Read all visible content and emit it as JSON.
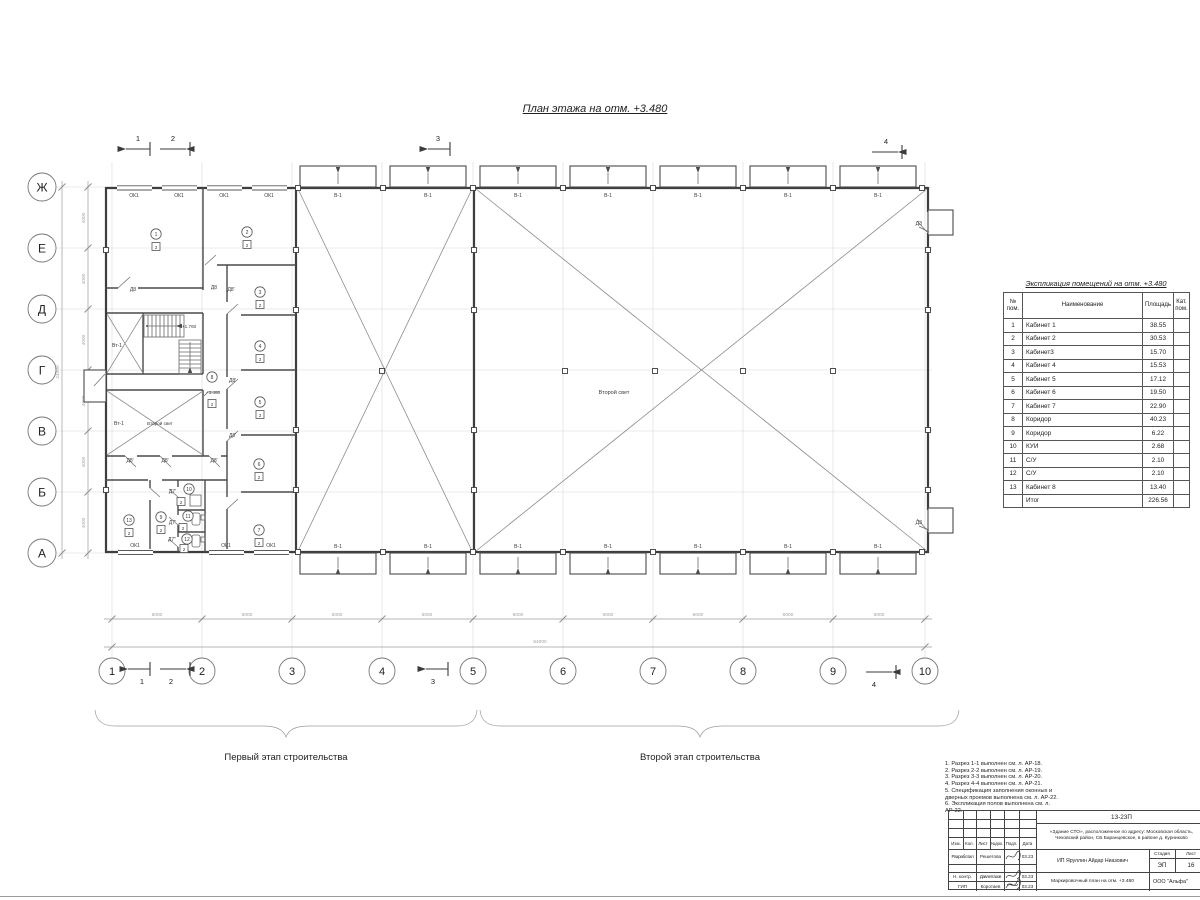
{
  "page": {
    "title": "План этажа на отм. +3.480"
  },
  "axes": {
    "h": [
      "1",
      "2",
      "3",
      "4",
      "5",
      "6",
      "7",
      "8",
      "9",
      "10"
    ],
    "v": [
      "Ж",
      "Е",
      "Д",
      "Г",
      "В",
      "Б",
      "А"
    ],
    "bay_h": "6000",
    "total_h": "54000",
    "bay_v": "4000",
    "total_v": "24000"
  },
  "sections": [
    "1",
    "2",
    "3",
    "4"
  ],
  "labels": {
    "window": "ОК1",
    "gate": "В-1",
    "door_d3": "ДЗ",
    "door_d8": "Д8",
    "door_d8p": "Д8'",
    "door_d7p": "Д7'",
    "door_d7pp": "Д7\"",
    "vt": "Вт-1",
    "second_light": "Второй свет",
    "level_main": "+3.480",
    "level_stair": "+1.760"
  },
  "rooms": [
    {
      "n": "1",
      "cat": "2"
    },
    {
      "n": "2",
      "cat": "2"
    },
    {
      "n": "3",
      "cat": "2"
    },
    {
      "n": "4",
      "cat": "2"
    },
    {
      "n": "5",
      "cat": "2"
    },
    {
      "n": "6",
      "cat": "2"
    },
    {
      "n": "7",
      "cat": "2"
    },
    {
      "n": "8",
      "cat": "2"
    },
    {
      "n": "9",
      "cat": "2"
    },
    {
      "n": "10",
      "cat": "2"
    },
    {
      "n": "11",
      "cat": "2"
    },
    {
      "n": "12",
      "cat": "2"
    },
    {
      "n": "13",
      "cat": "2"
    }
  ],
  "stages": {
    "first": "Первый этап строительства",
    "second": "Второй этап строительства"
  },
  "explication": {
    "title": "Экспликация помещений на отм. +3.480",
    "col_num": "№ пом.",
    "col_name": "Наименование",
    "col_area": "Площадь",
    "col_cat": "Кат. пом.",
    "rows": [
      {
        "n": "1",
        "name": "Кабинет 1",
        "area": "38.55"
      },
      {
        "n": "2",
        "name": "Кабинет 2",
        "area": "30.53"
      },
      {
        "n": "3",
        "name": "Кабинет3",
        "area": "15.70"
      },
      {
        "n": "4",
        "name": "Кабинет 4",
        "area": "15.53"
      },
      {
        "n": "5",
        "name": "Кабинет 5",
        "area": "17.12"
      },
      {
        "n": "6",
        "name": "Кабинет 6",
        "area": "19.50"
      },
      {
        "n": "7",
        "name": "Кабинет 7",
        "area": "22.90"
      },
      {
        "n": "8",
        "name": "Коридор",
        "area": "40.23"
      },
      {
        "n": "9",
        "name": "Коридор",
        "area": "6.22"
      },
      {
        "n": "10",
        "name": "КУИ",
        "area": "2.68"
      },
      {
        "n": "11",
        "name": "С/У",
        "area": "2.10"
      },
      {
        "n": "12",
        "name": "С/У",
        "area": "2.10"
      },
      {
        "n": "13",
        "name": "Кабинет 8",
        "area": "13.40"
      }
    ],
    "total_label": "Итог",
    "total_area": "226.56"
  },
  "notes": [
    "1. Разрез 1-1 выполнен см. л. АР-18.",
    "2. Разрез 2-2 выполнен см. л. АР-19.",
    "3. Разрез 3-3 выполнен см. л. АР-20.",
    "4. Разрез 4-4 выполнен см. л. АР-21.",
    "5. Спецификация заполнения оконных и дверных проемов выполнена см. л. АР-22.",
    "6. Экспликация полов выполнена см. л. АР-22."
  ],
  "titleblock": {
    "code": "13-23П",
    "address": "«Здание СТО», расположенное по адресу: Московская область, Чеховский район, СБ Баранцевское, в районе д. Курниково",
    "cols": {
      "izm": "Изм.",
      "kol": "Кол.",
      "list": "Лист",
      "ndok": "№док.",
      "podl": "Подл.",
      "data": "Дата"
    },
    "rows": [
      {
        "role": "Разработал",
        "name": "Решетова",
        "date": "03.23"
      },
      {
        "role": "Н. контр.",
        "name": "Давлетгазов",
        "date": "03.23"
      },
      {
        "role": "ГИП",
        "name": "Коротаев",
        "date": "03.23"
      }
    ],
    "client": "ИП Яруллин Айдар Ниазович",
    "stage_label": "Стадия",
    "sheet_label": "Лист",
    "stage": "ЭП",
    "sheet": "16",
    "doc_title": "Маркировочный план на отм. +3.480",
    "company": "ООО \"Альфа\""
  },
  "palette": {
    "paper": "#ffffff",
    "ink": "#3e3e3e",
    "light": "#9c9c9c"
  }
}
